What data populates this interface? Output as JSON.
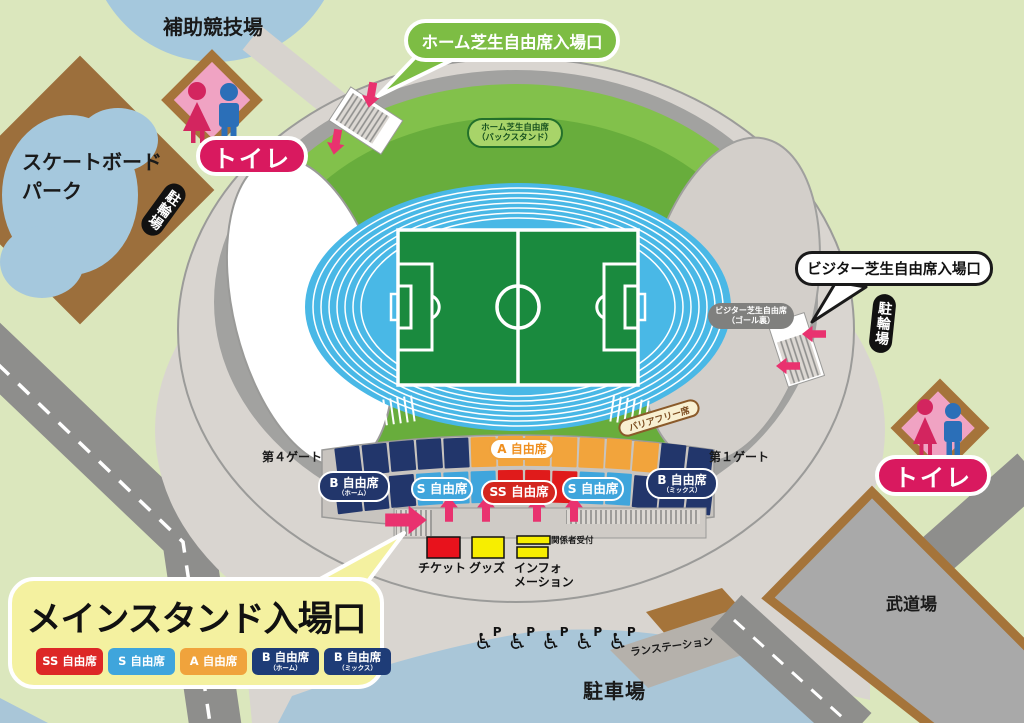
{
  "map": {
    "auxiliary_field_label": "補助競技場",
    "skateboard_park_line1": "スケートボード",
    "skateboard_park_line2": "パーク",
    "toilet_nw_label": "トイレ",
    "toilet_se_label": "トイレ",
    "bicycle_parking_nw": "駐輪場",
    "bicycle_parking_se": "駐輪場",
    "budokan_label": "武道場",
    "parking_label": "駐車場",
    "run_station_label": "ランステーション",
    "accessible_parking_letter": "P"
  },
  "callouts": {
    "home_lawn_entrance": "ホーム芝生自由席入場口",
    "visitor_lawn_entrance": "ビジター芝生自由席入場口",
    "main_stand_entrance": "メインスタンド入場口"
  },
  "stadium": {
    "home_lawn_line1": "ホーム芝生自由席",
    "home_lawn_line2": "（バックスタンド）",
    "visitor_lawn_line1": "ビジター芝生自由席",
    "visitor_lawn_line2": "（ゴール裏）",
    "barrier_free_label": "バリアフリー席",
    "gate4_label": "第４ゲート",
    "gate1_label": "第１ゲート",
    "seats": {
      "b_home_main": "B 自由席",
      "b_home_sub": "（ホーム）",
      "s_left": "S 自由席",
      "ss_center": "SS 自由席",
      "s_right": "S 自由席",
      "b_mix_main": "B 自由席",
      "b_mix_sub": "（ミックス）",
      "a_top": "A 自由席"
    }
  },
  "facilities": {
    "ticket": "チケット",
    "goods": "グッズ",
    "info_line1": "インフォ",
    "info_line2": "メーション",
    "staff_reception": "関係者受付"
  },
  "legend": {
    "items": [
      {
        "label": "SS 自由席",
        "sub": "",
        "color": "#dd2726"
      },
      {
        "label": "S 自由席",
        "sub": "",
        "color": "#3fa5dc"
      },
      {
        "label": "A 自由席",
        "sub": "",
        "color": "#f0a33c"
      },
      {
        "label": "B 自由席",
        "sub": "（ホーム）",
        "color": "#1e3c77"
      },
      {
        "label": "B 自由席",
        "sub": "（ミックス）",
        "color": "#1e3c77"
      }
    ]
  },
  "colors": {
    "accent_pink_arrow": "#e9326f",
    "toilet_badge_red": "#d9195f",
    "seat_navy": "#22366b",
    "seat_light_blue": "#3fa5dc",
    "seat_orange": "#f2a43c",
    "seat_red": "#e01b1b",
    "track_blue": "#49b8e6",
    "pitch_green": "#1a8a3e",
    "lawn_green": "#82c14b",
    "parking_blue": "#a9c6d8",
    "callout_yellow": "#f4f1a0",
    "bubble_green": "#7dbd44"
  }
}
